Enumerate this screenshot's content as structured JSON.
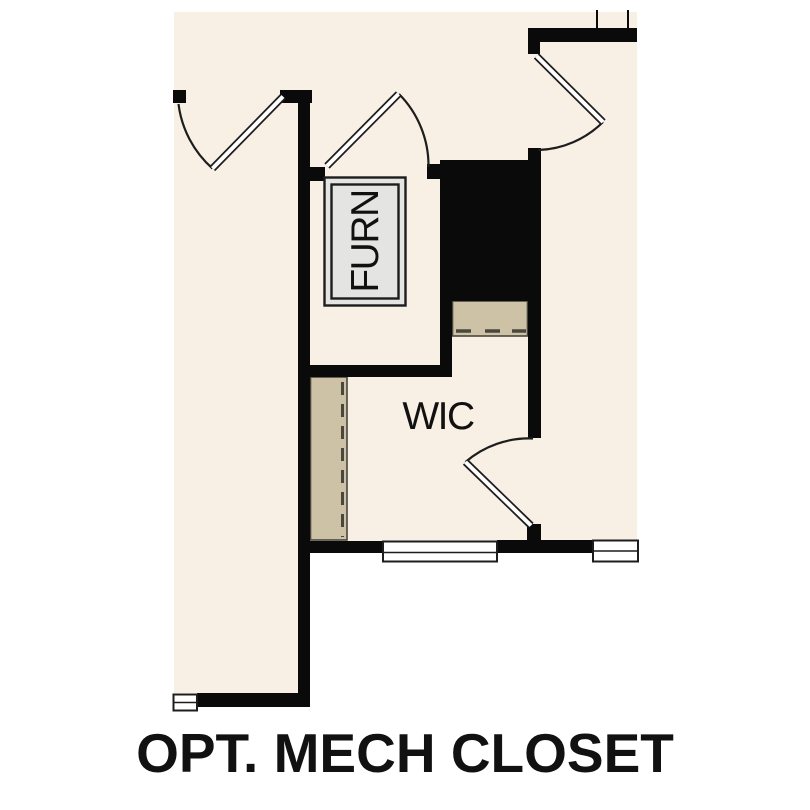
{
  "image_title": "OPT. MECH CLOSET floor plan",
  "caption": "OPT. MECH CLOSET",
  "labels": {
    "furnace": "FURN",
    "walk_in_closet": "WIC"
  },
  "colors": {
    "background": "#ffffff",
    "floor_cream": "#f8f0e4",
    "wall_black": "#0a0a0a",
    "closet_tan": "#cdc1a6",
    "tan_border": "#4a473f",
    "furnace_fill": "#e4e4e2",
    "line_dark": "#1d1d1d",
    "text": "#111111"
  },
  "features": [
    "hall-door-swing",
    "furnace-room-door-swing",
    "upper-right-door-swing",
    "wic-door-swing",
    "mech-closet-filled-mass",
    "furnace-unit-box",
    "closet-shelf-with-rod-dashes",
    "wic-shelf-with-rod-dashes",
    "window-lower-left",
    "window-lower-right",
    "wall-cut-marks-top",
    "wall-cut-mark-bottom-left"
  ]
}
